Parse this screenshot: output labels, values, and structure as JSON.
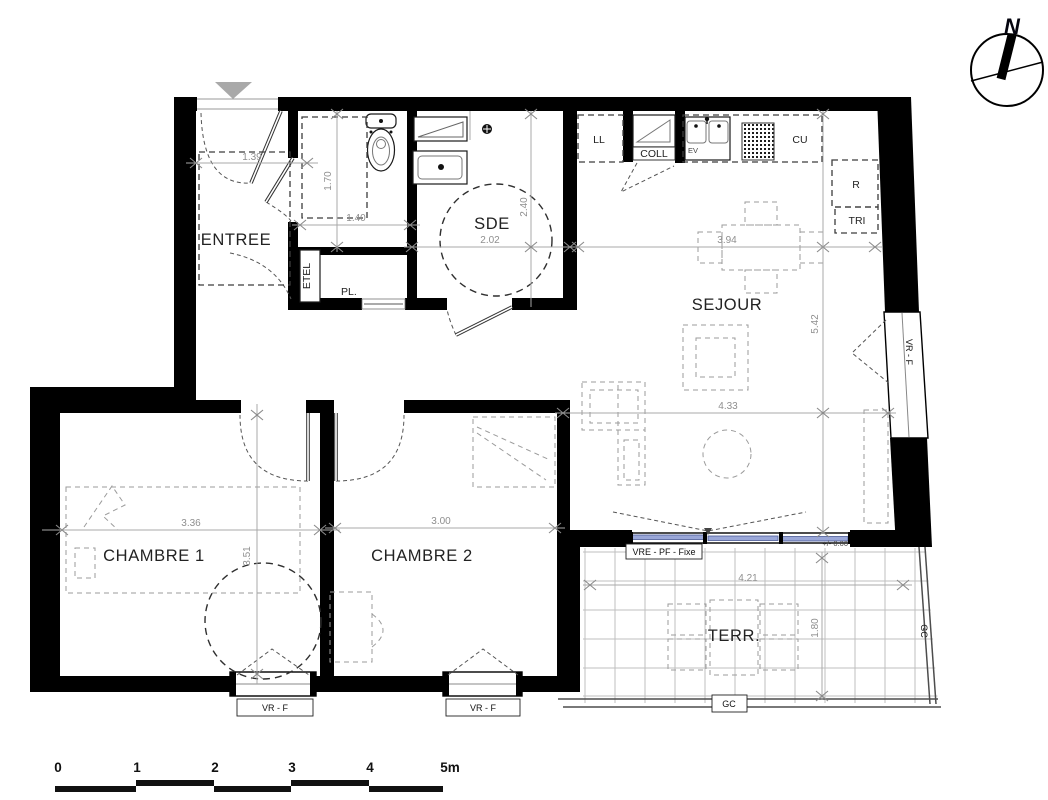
{
  "compass": {
    "north_label": "N"
  },
  "rooms": {
    "entree": "ENTREE",
    "sde": "SDE",
    "sejour": "SEJOUR",
    "chambre1": "CHAMBRE 1",
    "chambre2": "CHAMBRE 2",
    "terrasse": "TERR."
  },
  "fixtures": {
    "etel": "ETEL",
    "placard": "PL.",
    "lave_linge": "LL",
    "colonne": "COLL",
    "evier": "EV",
    "cuisine": "CU",
    "refrigerateur": "R",
    "tri": "TRI"
  },
  "openings": {
    "window_right": "VR - F",
    "window_chambre1": "VR - F",
    "window_chambre2": "VR - F",
    "bay_fixed": "VRE - PF - Fixe",
    "level": "+/- 0.00",
    "guardrail_bottom": "GC",
    "guardrail_right": "GC"
  },
  "dimensions": {
    "entree_width": "1.39",
    "wc_depth": "1.70",
    "wc_width": "1.40",
    "sde_width": "2.02",
    "sde_depth": "2.40",
    "kitchen_width": "3.94",
    "sejour_depth": "5.42",
    "sejour_width": "4.33",
    "chambre1_width": "3.36",
    "chambre1_depth": "3.51",
    "chambre2_width": "3.00",
    "terrasse_width": "4.21",
    "terrasse_depth": "1.80"
  },
  "scale_bar": {
    "labels": [
      "0",
      "1",
      "2",
      "3",
      "4",
      "5m"
    ]
  },
  "colors": {
    "wall": "#000000",
    "glazing": "#9aa7d8",
    "dimension": "#8f8f8f",
    "label": "#222222"
  }
}
